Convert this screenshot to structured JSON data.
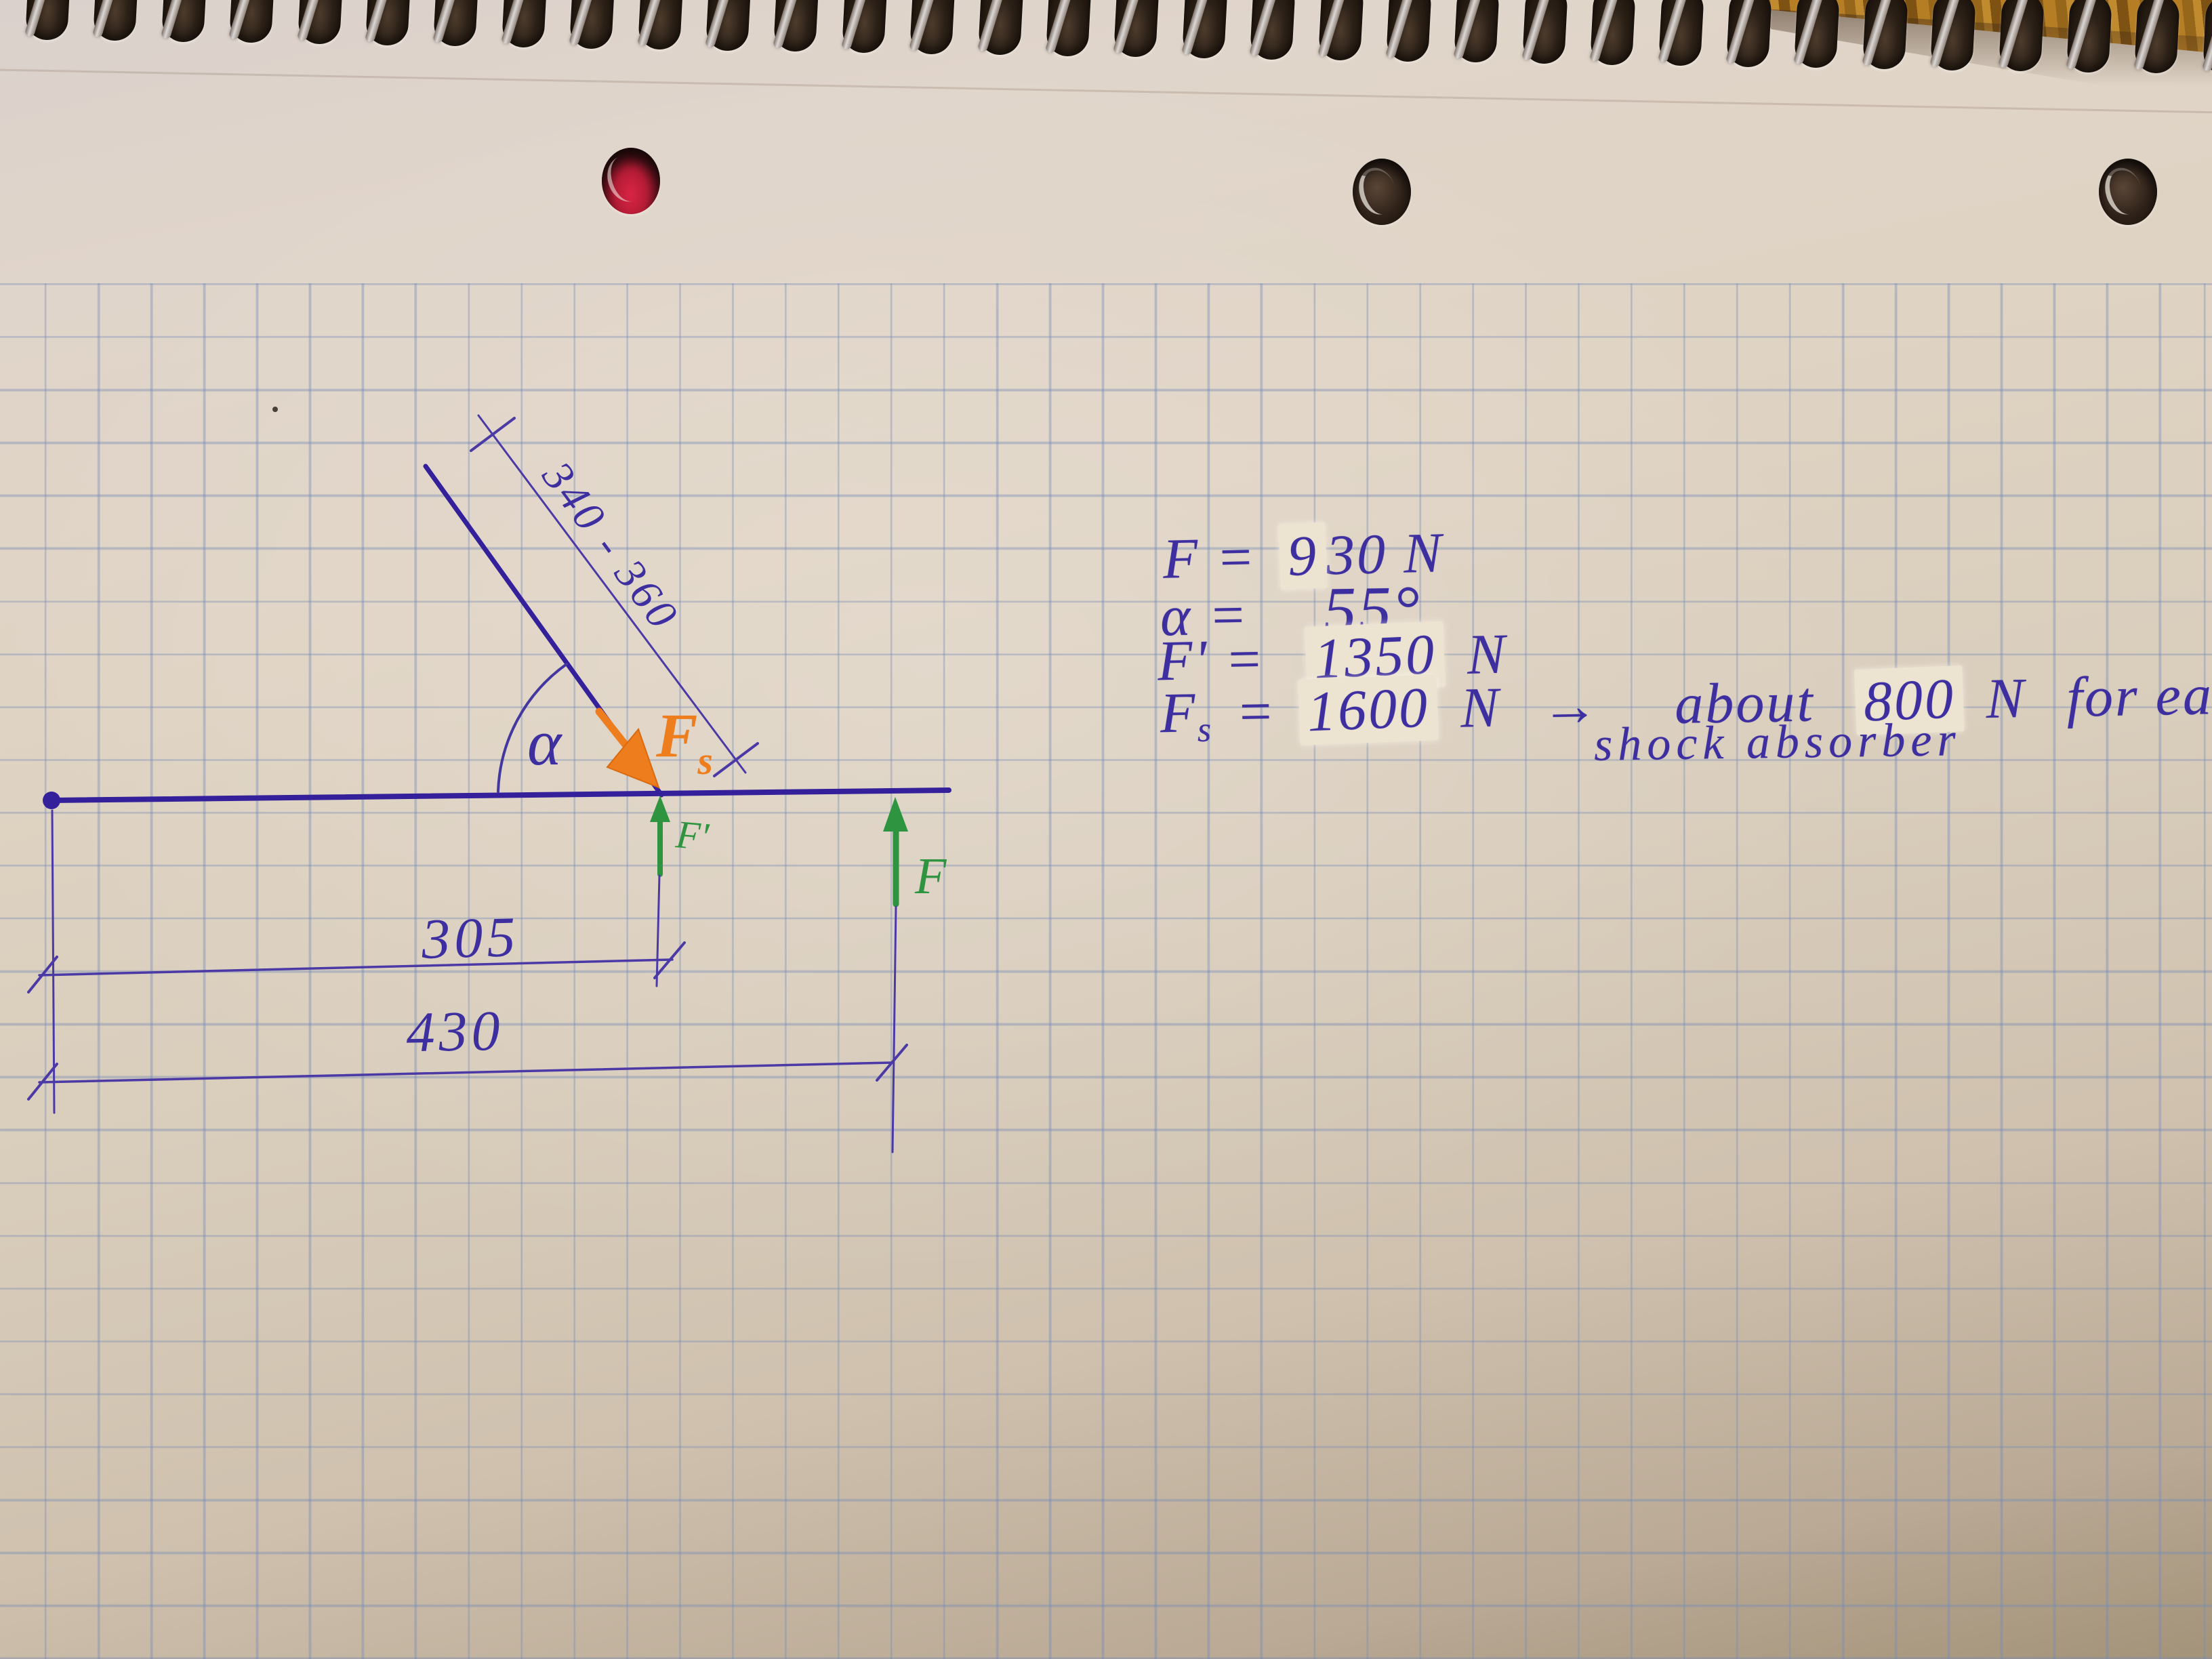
{
  "diagram": {
    "slant_dim_label": "340 - 360",
    "angle_label": "α",
    "spring_force_label": "F",
    "spring_force_sub": "s",
    "fprime_label": "F'",
    "f_label": "F",
    "dim_305": "305",
    "dim_430": "430"
  },
  "notes": {
    "f_lhs": "F =",
    "f_patched": "9",
    "f_rest": "30 N",
    "alpha_lhs": "α =",
    "alpha_value": "55°",
    "fprime_lhs": "F' =",
    "fprime_patched": "1350",
    "fprime_unit": "N",
    "fs_lhs": "F",
    "fs_sub": "s",
    "fs_eq": "=",
    "fs_patched": "1600",
    "fs_unit": "N",
    "arrow": "→",
    "about": "about",
    "about_patched": "800",
    "about_unit": "N",
    "for_each": "for each",
    "line2": "shock absorber"
  },
  "colors": {
    "ink": "#3d2f9f",
    "beam": "#33209a",
    "thin_line": "#4b3aa6",
    "orange": "#ee7d1e",
    "green": "#2e9440",
    "paper": "#d9cdbc"
  }
}
